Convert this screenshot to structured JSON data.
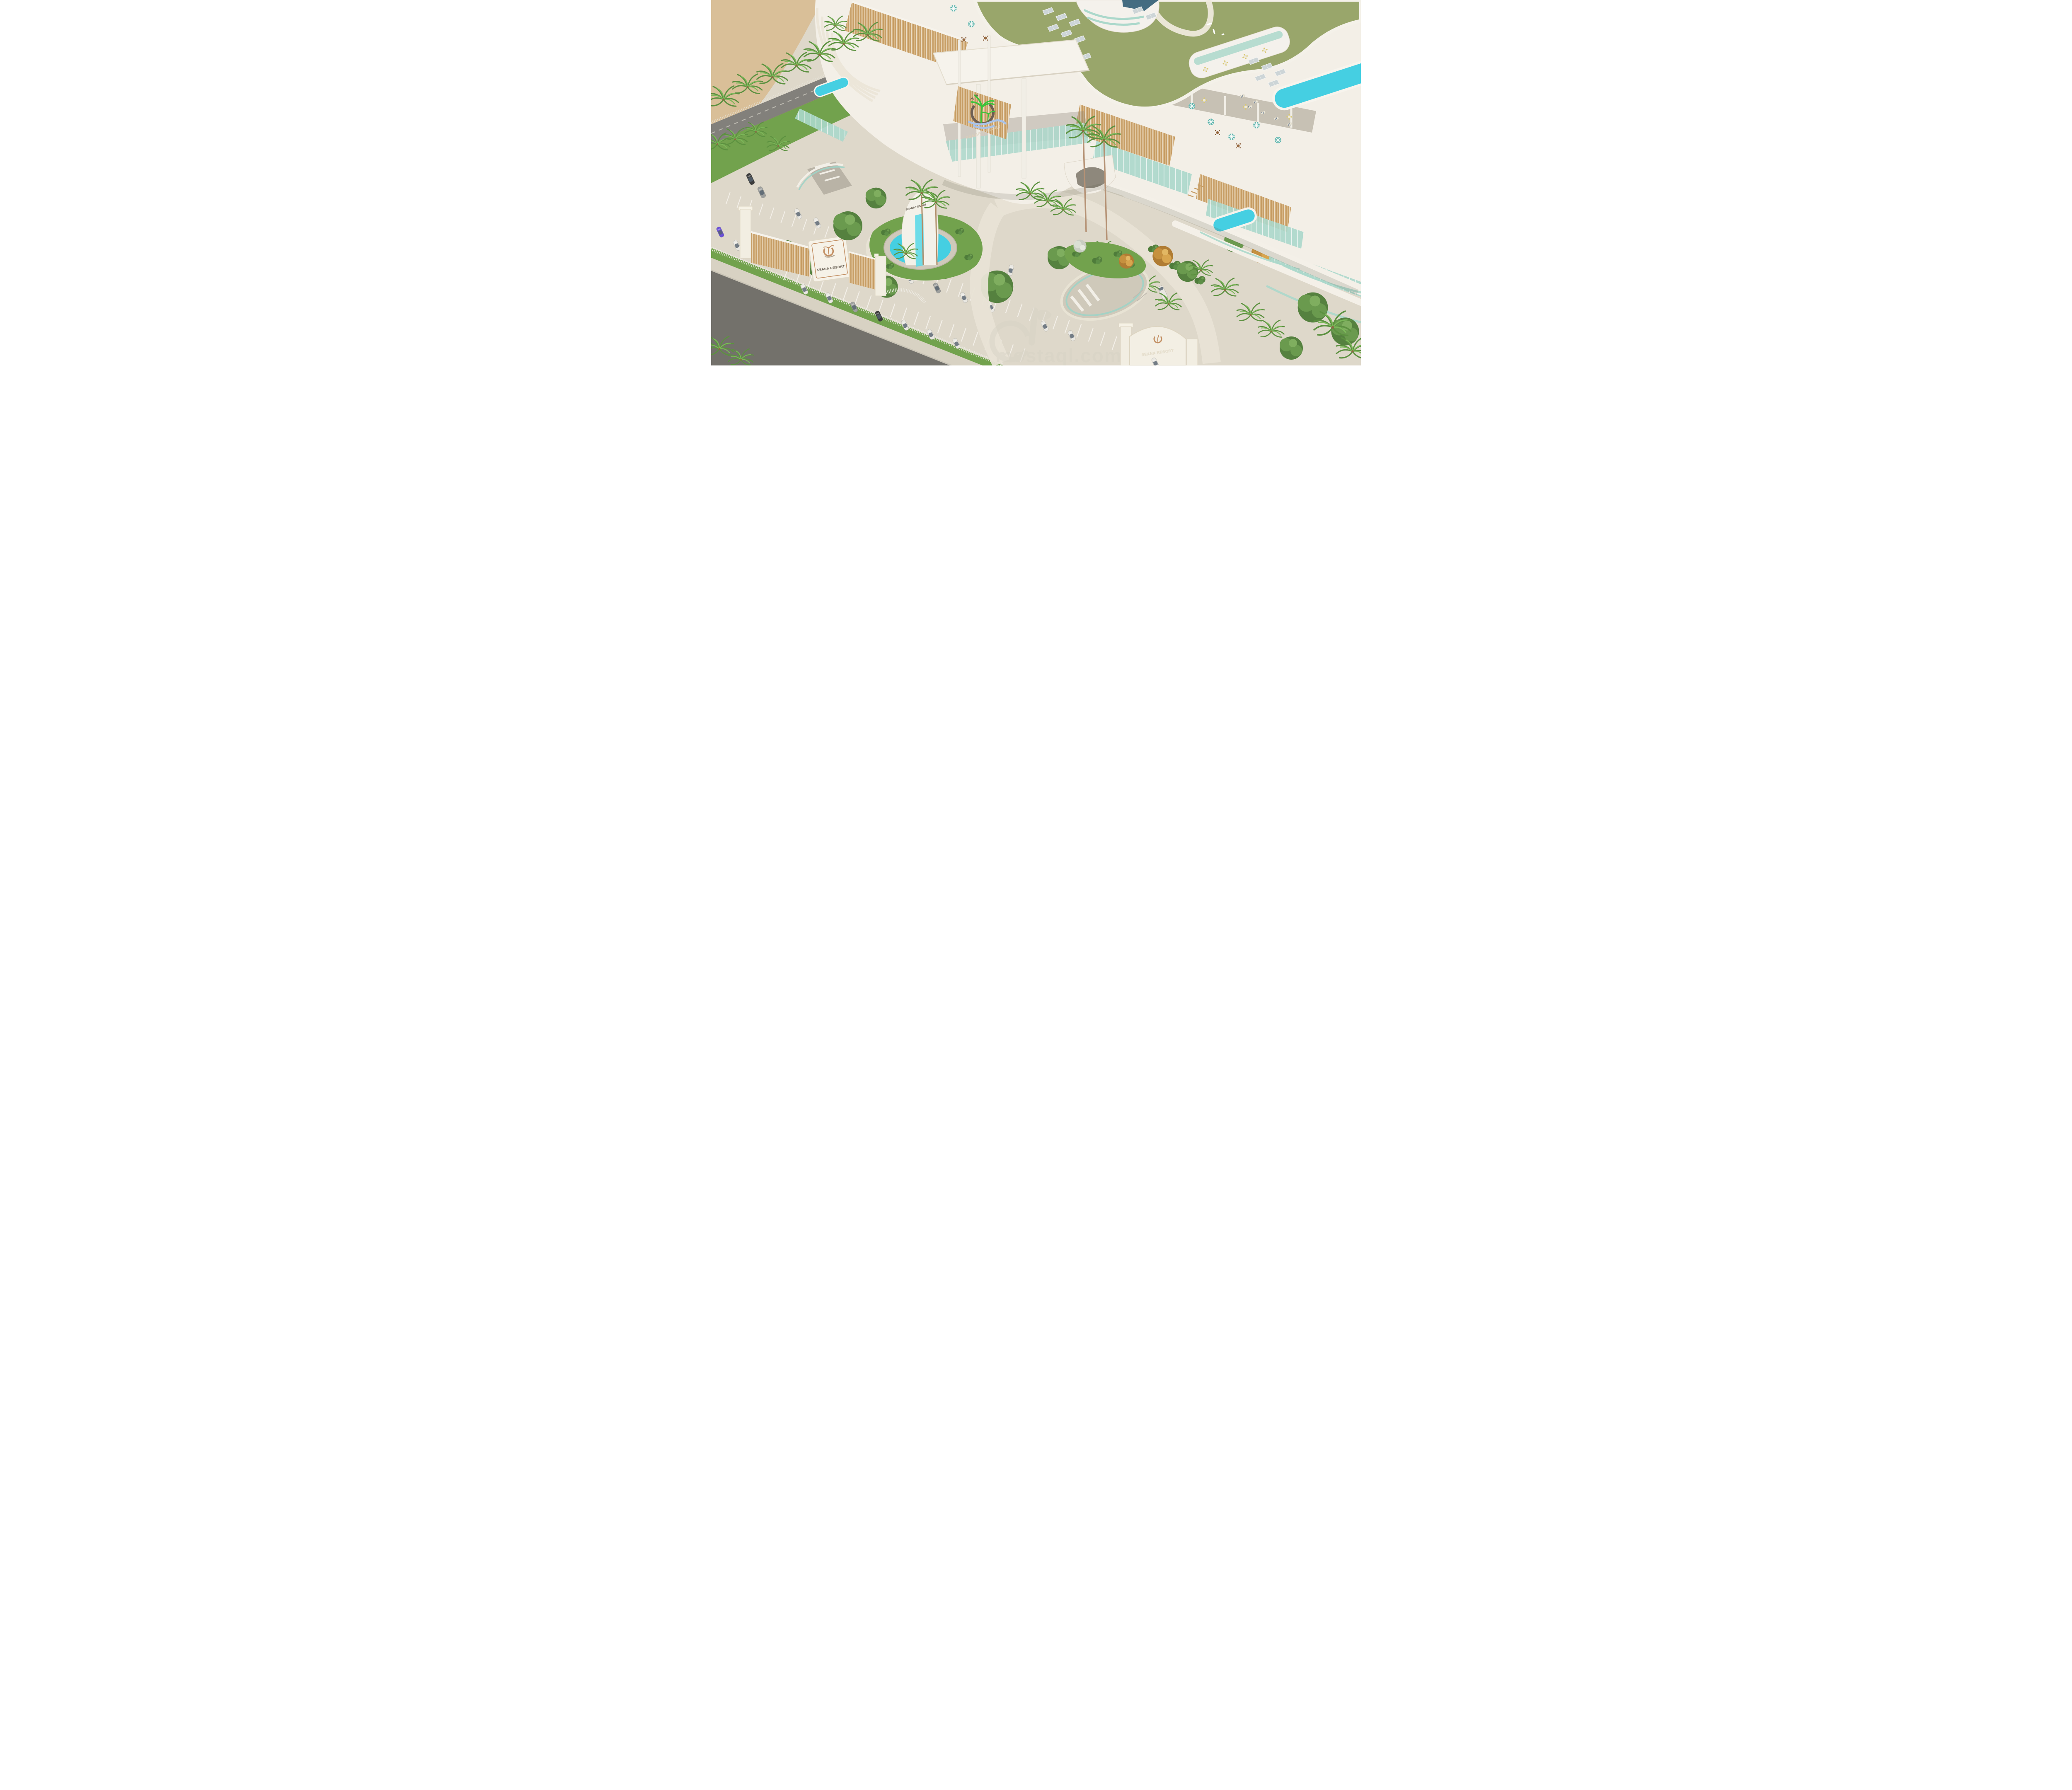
{
  "scene": {
    "type": "3d-architectural-rendering",
    "subject": "Aerial rendering of the Seana Resort: curved white hotel with green solar roof, rooftop pools and terraces, palm landscaping, entry gates, fountain and parking"
  },
  "resort": {
    "name": "SEANA RESORT",
    "facade_sign": "SEANA RESORT",
    "main_gate_sign": "SEANA RESORT",
    "fountain_sign": "SEANA RESORT",
    "south_gate_sign": "SEANA RESORT"
  },
  "watermark": {
    "text": "mostaql.com",
    "logo_icon": "mostaql-logo"
  },
  "colors": {
    "sand": "#d9bf98",
    "beach_road": "#82807b",
    "street": "#73716b",
    "sidewalk": "#d8d2c3",
    "paving": "#ded8ca",
    "grass": "#72a24d",
    "green_roof": "#99a66b",
    "building": "#f3efe7",
    "wood": "#c79e66",
    "glass": "#abd8cb",
    "pool": "#45cfe2",
    "umbrella": "#5fb5ad",
    "fence_white": "#efede6",
    "solar": "#cdd5d7",
    "sign_text": "#6b6257",
    "sign_panel": "#f6f2e8",
    "logo_tan": "#c28e62",
    "logo_green": "#3bc43b",
    "logo_brown": "#6e5f53",
    "logo_wave": "#aac3e8",
    "facade_letters": "#dbcfb9",
    "watermark_color": "#d8d3c6",
    "car_white": "#e9e7e1",
    "car_gray": "#9d9f9d",
    "car_dark": "#3c3c3c",
    "car_purple": "#6a4fd8"
  }
}
